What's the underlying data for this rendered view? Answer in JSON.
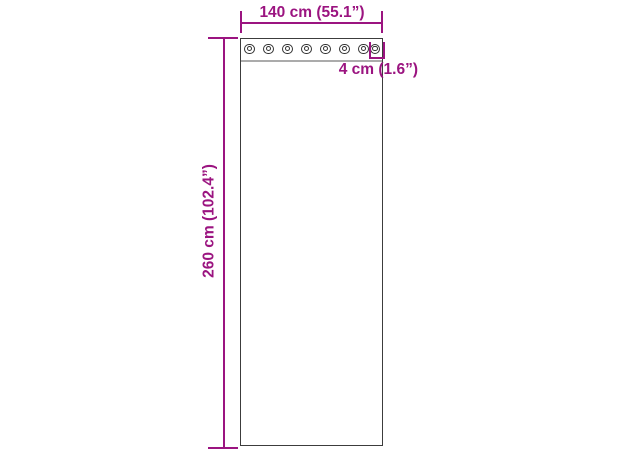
{
  "diagram": {
    "title": "Curtain panel with grommets — dimension diagram",
    "colors": {
      "accent": "#9B1480",
      "panel_border": "#3C3C3C",
      "band_line": "#ABABAB",
      "grommet_ring": "#333333",
      "background": "#FFFFFF"
    },
    "dimensions": {
      "width_label": "140 cm (55.1”)",
      "height_label": "260 cm (102.4”)",
      "grommet_label": "4 cm (1.6”)"
    },
    "grommets": {
      "count": 8
    }
  }
}
